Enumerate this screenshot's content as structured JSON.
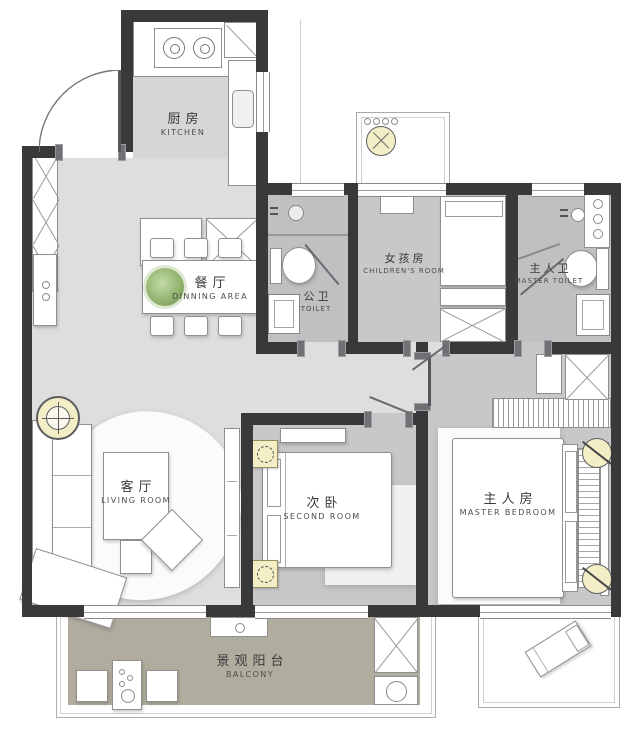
{
  "plan_type": "apartment-floor-plan",
  "rooms": {
    "kitchen": {
      "zh": "厨房",
      "en": "KITCHEN"
    },
    "dining": {
      "zh": "餐厅",
      "en": "DINNING AREA"
    },
    "public_toilet": {
      "zh": "公卫",
      "en": "TOILET"
    },
    "children_room": {
      "zh": "女孩房",
      "en": "CHILDREN'S ROOM"
    },
    "master_toilet": {
      "zh": "主人卫",
      "en": "MASTER TOILET"
    },
    "living_room": {
      "zh": "客厅",
      "en": "LIVING ROOM"
    },
    "second_room": {
      "zh": "次卧",
      "en": "SECOND ROOM"
    },
    "master_bedroom": {
      "zh": "主人房",
      "en": "MASTER BEDROOM"
    },
    "balcony": {
      "zh": "景观阳台",
      "en": "BALCONY"
    }
  },
  "colors": {
    "wall": "#39393b",
    "floor_light": "#dedede",
    "floor_kitchen": "#d6d6d7",
    "floor_room": "#c8c8ca",
    "floor_bath": "#c0c0c2",
    "floor_balcony": "#b1ad9e",
    "lamp_accent": "#f3eec5",
    "plant": "#8fb06a",
    "furniture_outline": "#8f8f8f"
  },
  "fixtures": [
    "entry-door",
    "shoe-cabinet",
    "gas-stove",
    "refrigerator",
    "kitchen-counter",
    "kitchen-sink",
    "kitchen-island",
    "dining-table",
    "dining-chair",
    "potted-plant",
    "sideboard",
    "toilet-bowl",
    "washbasin",
    "corner-sink",
    "shower-head",
    "storage-niche",
    "bay-window",
    "hanging-chair",
    "study-desk",
    "single-bed",
    "wardrobe",
    "ceiling-lamp",
    "sofa",
    "coffee-table",
    "ottoman",
    "area-rug",
    "tv-cabinet",
    "double-bed",
    "bedside-lamp",
    "nightstand",
    "bedroom-bench",
    "balcony-stool",
    "tea-table",
    "laundry-cabinet",
    "mop-basin",
    "lounge-chair",
    "sliding-window"
  ]
}
